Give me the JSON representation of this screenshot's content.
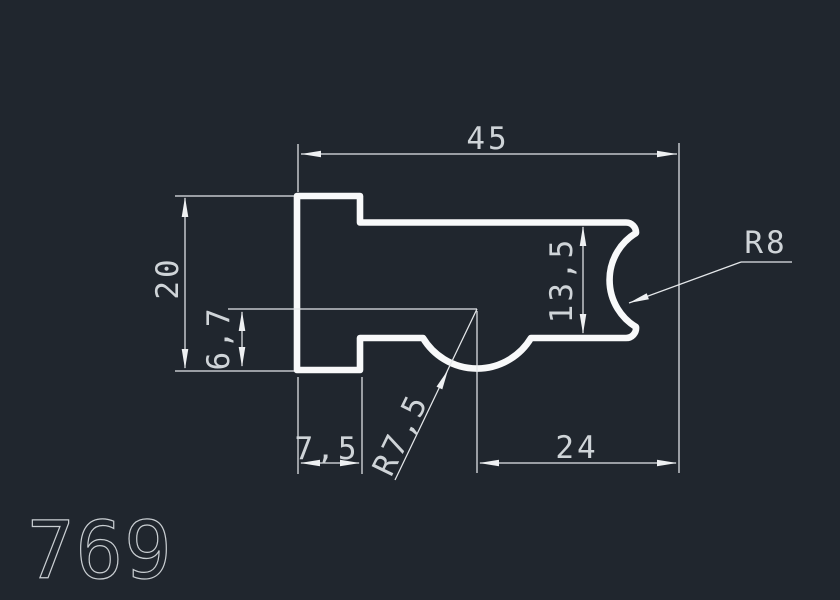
{
  "drawing": {
    "part_number": "769",
    "background_color": "#20262e",
    "profile_color": "#f8f9fa",
    "dim_line_color": "#e4e7ea",
    "dim_text_color": "#cfd4d8",
    "dimensions": {
      "overall_width": "45",
      "overall_height": "20",
      "inner_height": "6,7",
      "right_opening_height": "13,5",
      "right_notch_radius": "R8",
      "left_foot_width": "7,5",
      "bottom_bulge_radius": "R7,5",
      "bottom_right_width": "24"
    }
  }
}
